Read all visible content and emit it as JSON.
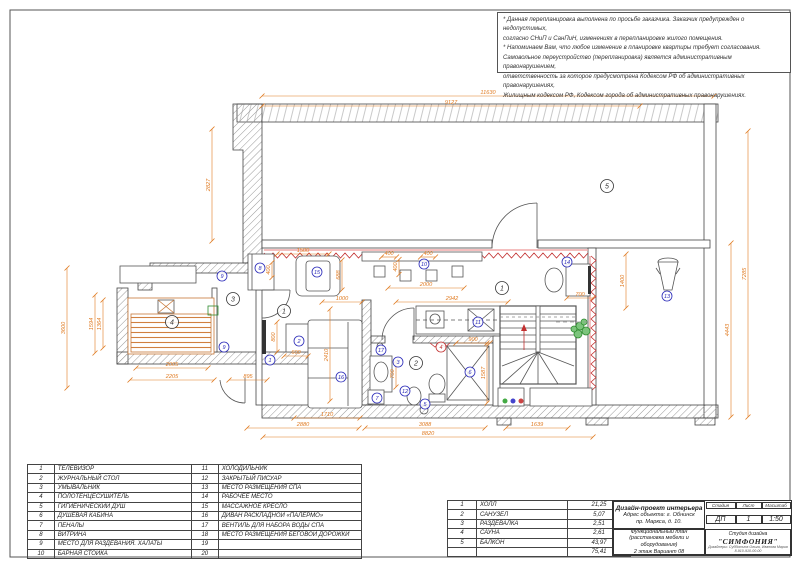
{
  "accent_colors": {
    "dimension_orange": "#e07a20",
    "trim_red": "#c23030",
    "item_blue": "#2828b8",
    "plant_green": "#2e8b2e",
    "sauna_orange": "#c87838"
  },
  "notes": {
    "lines": [
      "* Данная перепланировка выполнена по просьбе заказчика. Заказчик предупрежден о недопустимых,",
      "согласно СНиП и СанПиН, изменениях в перепланировке жилого помещения.",
      "* Напоминаем Вам, что любое изменение в планировке квартиры требует согласования.",
      "Самовольное переустройство (перепланировка) является административным правонарушением,",
      "ответственность за которое предусмотрена Кодексом РФ об административных правонарушениях,",
      "Жилищным кодексом РФ, Кодексом города об административных правонарушениях."
    ]
  },
  "legend": {
    "items": [
      {
        "n": "1",
        "label": "ТЕЛЕВИЗОР"
      },
      {
        "n": "2",
        "label": "ЖУРНАЛЬНЫЙ СТОЛ"
      },
      {
        "n": "3",
        "label": "УМЫВАЛЬНИК"
      },
      {
        "n": "4",
        "label": "ПОЛОТЕНЦЕСУШИТЕЛЬ"
      },
      {
        "n": "5",
        "label": "ГИГИЕНИЧЕСКИЙ ДУШ"
      },
      {
        "n": "6",
        "label": "ДУШЕВАЯ КАБИНА"
      },
      {
        "n": "7",
        "label": "ПЕНАЛЫ"
      },
      {
        "n": "8",
        "label": "ВИТРИНА"
      },
      {
        "n": "9",
        "label": "МЕСТО ДЛЯ РАЗДЕВАНИЯ. ХАЛАТЫ"
      },
      {
        "n": "10",
        "label": "БАРНАЯ СТОЙКА"
      },
      {
        "n": "11",
        "label": "ХОЛОДИЛЬНИК"
      },
      {
        "n": "12",
        "label": "ЗАКРЫТЫЙ ПИСУАР"
      },
      {
        "n": "13",
        "label": "МЕСТО РАЗМЕЩЕНИЯ СПА"
      },
      {
        "n": "14",
        "label": "РАБОЧЕЕ МЕСТО"
      },
      {
        "n": "15",
        "label": "МАССАЖНОЕ КРЕСЛО"
      },
      {
        "n": "16",
        "label": "ДИВАН РАСКЛАДНОЙ «ПАЛЕРМО»"
      },
      {
        "n": "17",
        "label": "ВЕНТИЛЬ ДЛЯ НАБОРА ВОДЫ СПА"
      },
      {
        "n": "18",
        "label": "МЕСТО РАЗМЕЩЕНИЯ БЕГОВОЙ ДОРОЖКИ"
      },
      {
        "n": "19",
        "label": ""
      },
      {
        "n": "20",
        "label": ""
      }
    ]
  },
  "rooms": {
    "rows": [
      {
        "n": "1",
        "name": "ХОЛЛ",
        "area": "21,25"
      },
      {
        "n": "2",
        "name": "САНУЗЕЛ",
        "area": "5,07"
      },
      {
        "n": "3",
        "name": "РАЗДЕВАЛКА",
        "area": "2,51"
      },
      {
        "n": "4",
        "name": "САУНА",
        "area": "2,61"
      },
      {
        "n": "5",
        "name": "БАЛКОН",
        "area": "43,97"
      }
    ],
    "total": "75,41"
  },
  "title_block": {
    "project_title": "Дизайн-проект интерьера",
    "address_line1": "Адрес объекта: г. Обнинск",
    "address_line2": "пр. Маркса, д. 10.",
    "stage_label": "Стадия",
    "sheet_label": "Лист",
    "scale_label": "Масштаб",
    "stage": "ДП",
    "sheet": "1",
    "scale": "1:50",
    "plan_line1": "Функциональный план",
    "plan_line2": "(расстановка мебели и оборудования)",
    "plan_line3": "2 этаж    Вариант 08",
    "studio_label": "Студия дизайна",
    "studio_name": "\"СИМФОНИЯ\"",
    "studio_sub1": "Дизайнеры: Субботина Ольга, Иванова Мария",
    "studio_sub2": "8-910-910-00-00"
  },
  "plan": {
    "dims": [
      [
        "11630",
        488,
        96,
        "h",
        452
      ],
      [
        "9127",
        451,
        106,
        "h",
        378
      ],
      [
        "2827",
        212,
        185,
        "v",
        112
      ],
      [
        "3600",
        67,
        328,
        "v",
        120
      ],
      [
        "1594",
        95,
        324,
        "v",
        58
      ],
      [
        "1364",
        103,
        324,
        "v",
        48
      ],
      [
        "2005",
        172,
        368,
        "h",
        72
      ],
      [
        "2205",
        172,
        380,
        "h",
        84
      ],
      [
        "895",
        248,
        380,
        "h",
        38
      ],
      [
        "400",
        272,
        270,
        "v",
        15
      ],
      [
        "1500",
        303,
        254,
        "h",
        52
      ],
      [
        "688",
        342,
        275,
        "v",
        30
      ],
      [
        "1000",
        342,
        302,
        "h",
        40
      ],
      [
        "2942",
        452,
        302,
        "h",
        112
      ],
      [
        "2000",
        426,
        288,
        "h",
        76
      ],
      [
        "400",
        399,
        267,
        "v",
        15
      ],
      [
        "400",
        389,
        257,
        "h",
        15
      ],
      [
        "400",
        428,
        257,
        "h",
        15
      ],
      [
        "700",
        580,
        298,
        "h",
        26
      ],
      [
        "1400",
        626,
        281,
        "v",
        54
      ],
      [
        "7285",
        748,
        274,
        "v",
        286
      ],
      [
        "4443",
        731,
        330,
        "v",
        174
      ],
      [
        "600",
        296,
        356,
        "h",
        24
      ],
      [
        "800",
        277,
        337,
        "v",
        30
      ],
      [
        "2410",
        330,
        355,
        "v",
        92
      ],
      [
        "700",
        396,
        374,
        "v",
        26
      ],
      [
        "900",
        473,
        343,
        "h",
        34
      ],
      [
        "1587",
        487,
        373,
        "v",
        60
      ],
      [
        "1710",
        327,
        418,
        "h",
        66
      ],
      [
        "2880",
        303,
        428,
        "h",
        112
      ],
      [
        "3088",
        425,
        428,
        "h",
        120
      ],
      [
        "8820",
        428,
        437,
        "h",
        330
      ],
      [
        "1639",
        537,
        428,
        "h",
        62
      ]
    ],
    "room_markers": [
      [
        "1",
        284,
        311
      ],
      [
        "1",
        502,
        288
      ],
      [
        "2",
        416,
        363
      ],
      [
        "3",
        233,
        299
      ],
      [
        "4",
        172,
        322
      ],
      [
        "5",
        607,
        186
      ]
    ],
    "item_markers": [
      [
        "8",
        260,
        268
      ],
      [
        "15",
        317,
        272
      ],
      [
        "10",
        424,
        264
      ],
      [
        "14",
        567,
        262
      ],
      [
        "13",
        667,
        296
      ],
      [
        "17",
        381,
        350
      ],
      [
        "2",
        299,
        341
      ],
      [
        "16",
        341,
        377
      ],
      [
        "1",
        270,
        360
      ],
      [
        "3",
        398,
        362
      ],
      [
        "7",
        377,
        398
      ],
      [
        "12",
        405,
        391
      ],
      [
        "5",
        425,
        404
      ],
      [
        "6",
        470,
        372
      ],
      [
        "11",
        478,
        322
      ],
      [
        "9",
        222,
        276
      ],
      [
        "9",
        224,
        347
      ]
    ],
    "red_markers": [
      [
        "4",
        441,
        347
      ]
    ]
  }
}
